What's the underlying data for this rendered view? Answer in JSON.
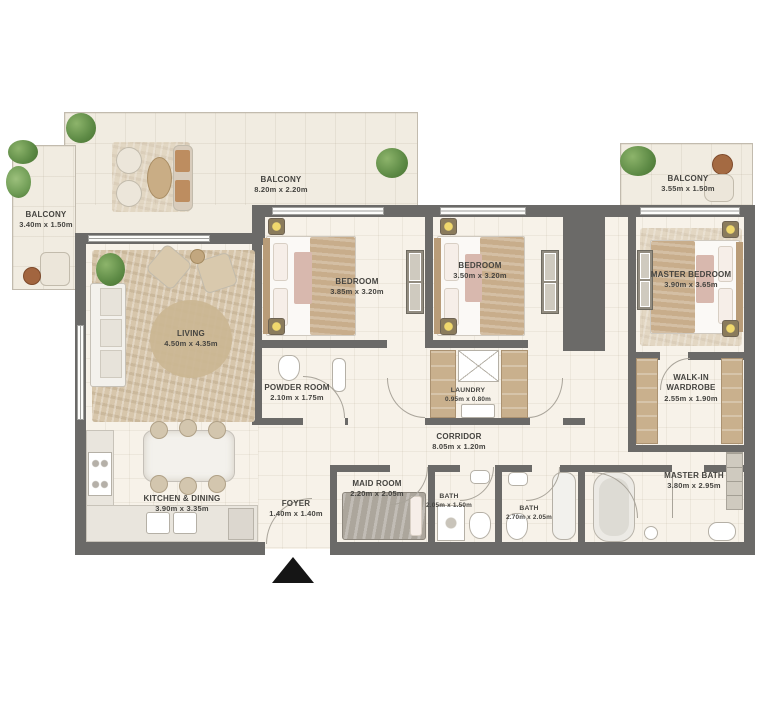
{
  "plan": {
    "title": "Apartment floor plan",
    "rooms": [
      {
        "id": "balcony-left",
        "name": "BALCONY",
        "dims": "3.40m x 1.50m"
      },
      {
        "id": "balcony-top",
        "name": "BALCONY",
        "dims": "8.20m x 2.20m"
      },
      {
        "id": "balcony-right",
        "name": "BALCONY",
        "dims": "3.55m x 1.50m"
      },
      {
        "id": "living",
        "name": "LIVING",
        "dims": "4.50m x 4.35m"
      },
      {
        "id": "bedroom-1",
        "name": "BEDROOM",
        "dims": "3.85m x 3.20m"
      },
      {
        "id": "bedroom-2",
        "name": "BEDROOM",
        "dims": "3.50m x 3.20m"
      },
      {
        "id": "master-bedroom",
        "name": "MASTER BEDROOM",
        "dims": "3.90m x 3.65m"
      },
      {
        "id": "powder-room",
        "name": "POWDER ROOM",
        "dims": "2.10m x 1.75m"
      },
      {
        "id": "laundry",
        "name": "LAUNDRY",
        "dims": "0.95m x 0.80m"
      },
      {
        "id": "walk-in-wardrobe",
        "name": "WALK-IN WARDROBE",
        "dims": "2.55m x 1.90m"
      },
      {
        "id": "corridor",
        "name": "CORRIDOR",
        "dims": "8.05m x 1.20m"
      },
      {
        "id": "kitchen-dining",
        "name": "KITCHEN & DINING",
        "dims": "3.90m x 3.35m"
      },
      {
        "id": "foyer",
        "name": "FOYER",
        "dims": "1.40m x 1.40m"
      },
      {
        "id": "maid-room",
        "name": "MAID ROOM",
        "dims": "2.20m x 2.05m"
      },
      {
        "id": "bath-1",
        "name": "BATH",
        "dims": "2.05m x 1.50m"
      },
      {
        "id": "bath-2",
        "name": "BATH",
        "dims": "2.70m x 2.05m"
      },
      {
        "id": "master-bath",
        "name": "MASTER BATH",
        "dims": "3.80m x 2.95m"
      }
    ],
    "entrance": {
      "marker": "triangle-up"
    },
    "colors": {
      "wall": "#6b6a68",
      "floor": "#f7f2e9",
      "balcony_floor": "#f1ece1",
      "wood": "#c9b08d",
      "rug": "#d7c6ab",
      "label_text": "#454440",
      "plant": "#5d8a45",
      "lamp": "#f0d86d",
      "arrow": "#151515"
    }
  }
}
